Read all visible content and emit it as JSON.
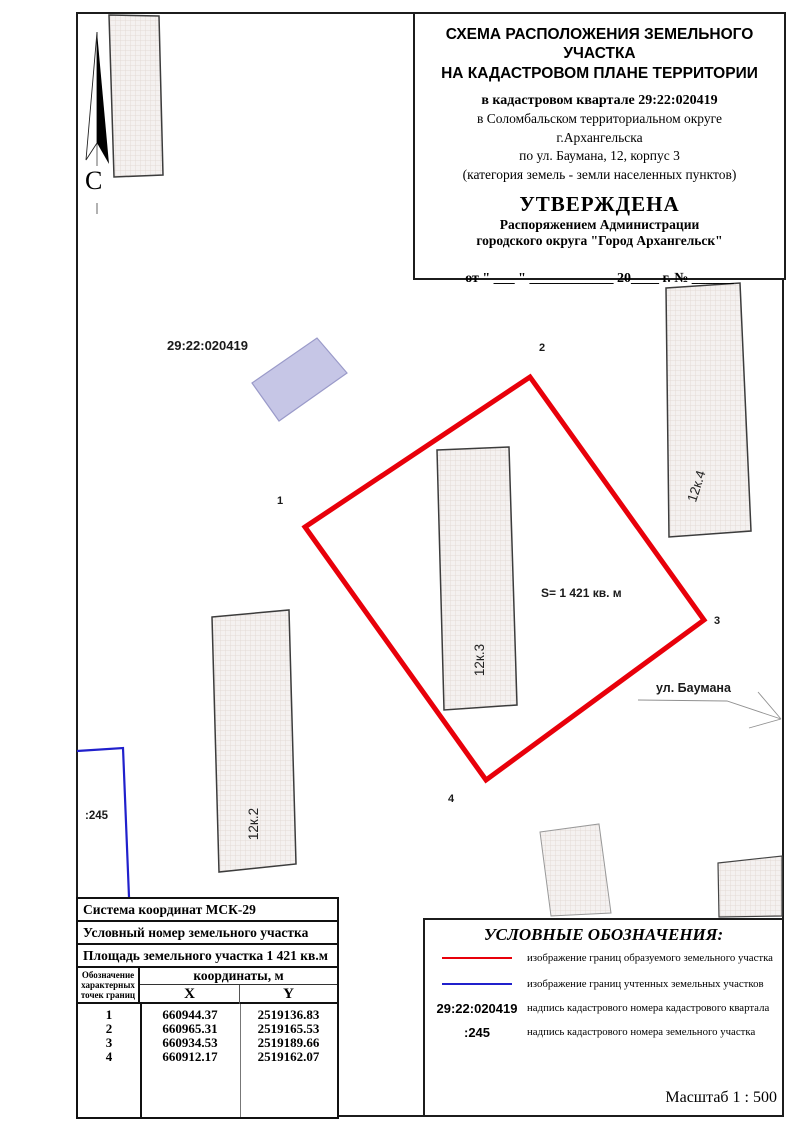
{
  "title_block": {
    "line1": "СХЕМА РАСПОЛОЖЕНИЯ ЗЕМЕЛЬНОГО УЧАСТКА",
    "line2": "НА КАДАСТРОВОМ ПЛАНЕ ТЕРРИТОРИИ",
    "quarter": "в кадастровом квартале 29:22:020419",
    "district": "в Соломбальском территориальном округе",
    "city": "г.Архангельска",
    "address": "по ул. Баумана, 12, корпус 3",
    "category": "(категория земель - земли населенных пунктов)",
    "approved": "УТВЕРЖДЕНА",
    "approved_by1": "Распоряжением Администрации",
    "approved_by2": "городского округа \"Город Архангельск\"",
    "date_line": "от \" ___ \" ____________ 20____  г. № ______"
  },
  "map": {
    "north_label": "С",
    "quarter_number": "29:22:020419",
    "area_label": "S= 1 421 кв. м",
    "street_label": "ул. Баумана",
    "parcel_number": ":245",
    "buildings": [
      {
        "label": "12к.2"
      },
      {
        "label": "12к.3"
      },
      {
        "label": "12к.4"
      }
    ],
    "points": [
      "1",
      "2",
      "3",
      "4"
    ]
  },
  "table": {
    "row1": "Система координат МСК-29",
    "row2": "Условный номер земельного участка",
    "row3": "Площадь земельного участка 1 421 кв.м",
    "col_points": "Обозначение характерных точек границ",
    "col_coords": "координаты, м",
    "col_x": "X",
    "col_y": "Y",
    "rows": [
      {
        "n": "1",
        "x": "660944.37",
        "y": "2519136.83"
      },
      {
        "n": "2",
        "x": "660965.31",
        "y": "2519165.53"
      },
      {
        "n": "3",
        "x": "660934.53",
        "y": "2519189.66"
      },
      {
        "n": "4",
        "x": "660912.17",
        "y": "2519162.07"
      }
    ]
  },
  "legend": {
    "title": "УСЛОВНЫЕ ОБОЗНАЧЕНИЯ:",
    "items": [
      {
        "sample": "",
        "text": "изображение границ образуемого земельного участка"
      },
      {
        "sample": "",
        "text": "изображение границ учтенных земельных участков"
      },
      {
        "sample": "29:22:020419",
        "text": "надпись кадастрового номера кадастрового квартала"
      },
      {
        "sample": ":245",
        "text": "надпись кадастрового номера земельного участка"
      }
    ]
  },
  "scale_label": "Масштаб  1 : 500",
  "colors": {
    "formed_boundary": "#e8000a",
    "registered_boundary": "#2020cc",
    "quarter_building": "#c6c6e6",
    "building_fill": "#f4f1f0"
  }
}
